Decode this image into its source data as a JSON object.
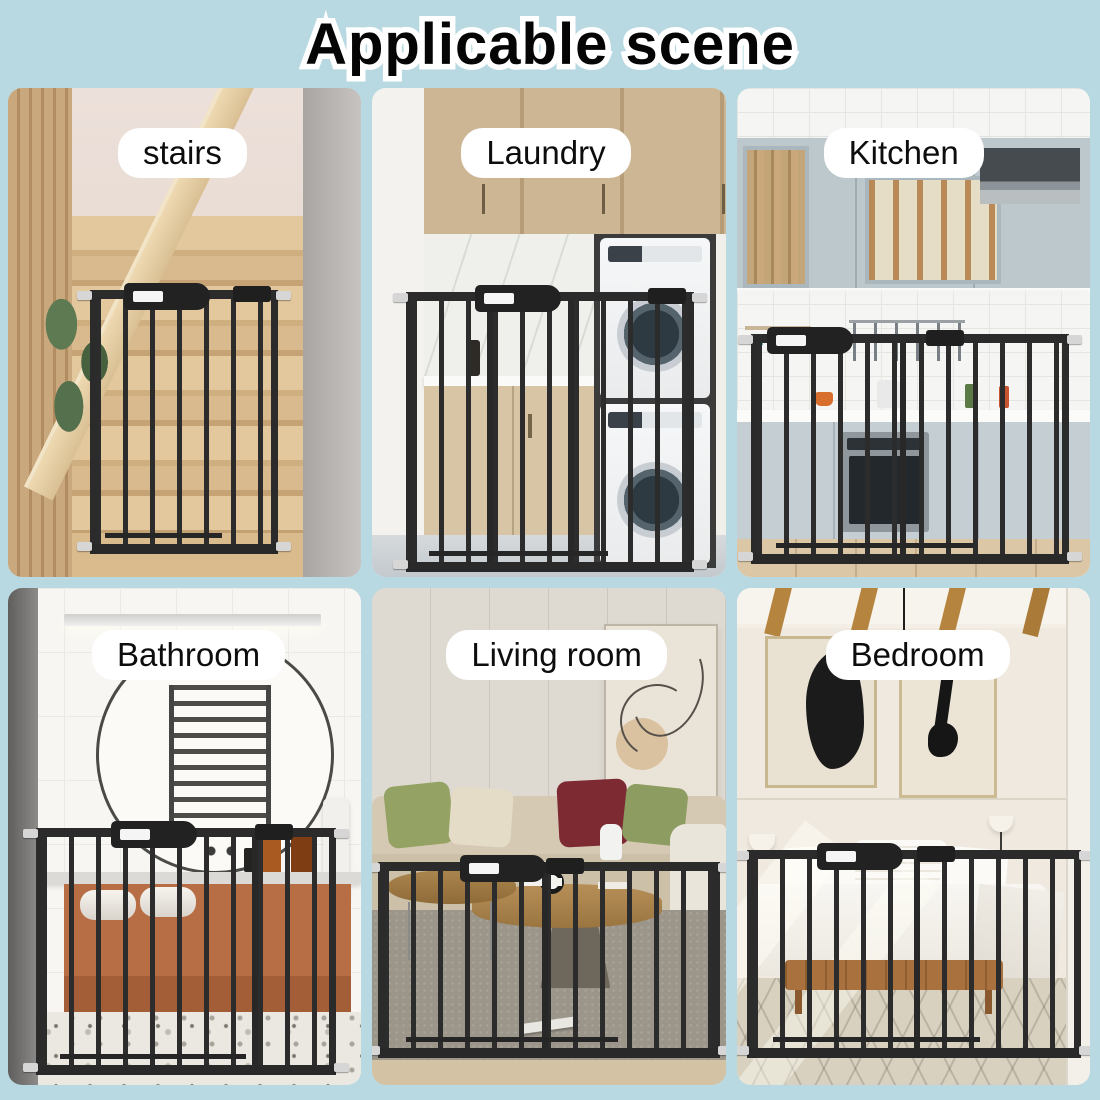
{
  "header": {
    "title": "Applicable scene"
  },
  "scenes": [
    {
      "name": "stairs",
      "label": "stairs"
    },
    {
      "name": "laundry",
      "label": "Laundry"
    },
    {
      "name": "kitchen",
      "label": "Kitchen"
    },
    {
      "name": "bathroom",
      "label": "Bathroom"
    },
    {
      "name": "living-room",
      "label": "Living room"
    },
    {
      "name": "bedroom",
      "label": "Bedroom"
    }
  ],
  "colors": {
    "page_background": "#b8d9e1",
    "gate": "#2b2b2b",
    "label_background": "#ffffff",
    "label_text": "#0d0d0d",
    "title_text": "#050505",
    "title_outline": "#ffffff"
  }
}
